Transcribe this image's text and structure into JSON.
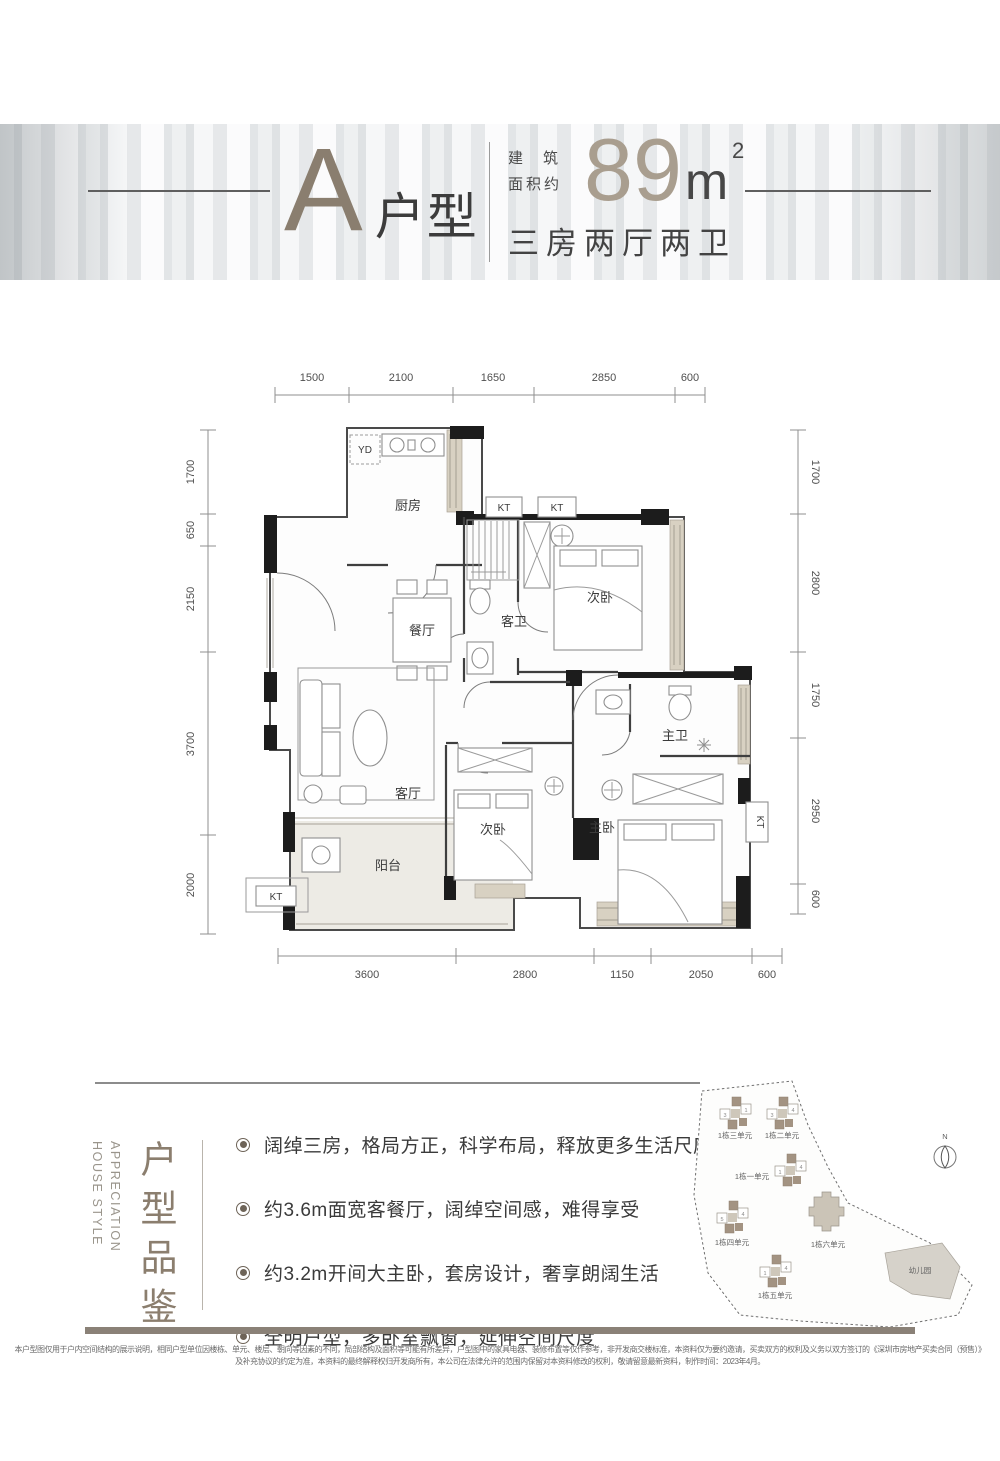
{
  "header": {
    "unit_letter": "A",
    "unit_label": "户型",
    "area_prefix_1": "建筑",
    "area_prefix_2": "面积约",
    "area_number": "89",
    "area_unit": "m",
    "area_sup": "2",
    "layout_desc": "三房两厅两卫"
  },
  "plan": {
    "rooms": {
      "kitchen": "厨房",
      "dining": "餐厅",
      "living": "客厅",
      "guest_bath": "客卫",
      "bedroom_top": "次卧",
      "bedroom_mid": "次卧",
      "master_bed": "主卧",
      "master_bath": "主卫",
      "balcony": "阳台"
    },
    "equipment": {
      "yd": "YD",
      "kt": "KT"
    },
    "dims": {
      "top": [
        "1500",
        "2100",
        "1650",
        "2850",
        "600"
      ],
      "bottom": [
        "3600",
        "2800",
        "1150",
        "2050",
        "600"
      ],
      "left": [
        "1700",
        "650",
        "2150",
        "3700",
        "2000"
      ],
      "right": [
        "1700",
        "2800",
        "1750",
        "2950",
        "600"
      ]
    }
  },
  "features": {
    "title_cn": "户型品鉴",
    "title_en_1": "HOUSE STYLE",
    "title_en_2": "APPRECIATION",
    "bullets": [
      "阔绰三房，格局方正，科学布局，释放更多生活尺度",
      "约3.6m面宽客餐厅，阔绰空间感，难得享受",
      "约3.2m开间大主卧，套房设计，奢享朗阔生活",
      "全明户型，多卧室飘窗，延伸空间尺度"
    ]
  },
  "siteplan": {
    "compass": "N",
    "units": [
      {
        "label": "1栋三单元",
        "digits": [
          "3",
          "1"
        ]
      },
      {
        "label": "1栋二单元",
        "digits": [
          "3",
          "4"
        ]
      },
      {
        "label": "1栋一单元",
        "digits": [
          "1",
          "4"
        ]
      },
      {
        "label": "1栋四单元",
        "digits": [
          "5",
          "4"
        ]
      },
      {
        "label": "1栋五单元",
        "digits": [
          "1",
          "4"
        ]
      },
      {
        "label": "1栋六单元",
        "digits": []
      }
    ],
    "kindergarten": "幼儿园"
  },
  "footer": {
    "disclaimer_line1": "本户型图仅用于户内空间结构的展示说明，相同户型单位因楼栋、单元、楼层、朝向等因素的不同，局部结构及面积等可能有所差异，户型图中的家具电器、装修布置等仅作参考，非开发商交楼标准，本资料仅为要约邀请，买卖双方的权利及义务以双方签订的《深圳市房地产买卖合同（预售）》",
    "disclaimer_line2": "及补充协议的约定为准，本资料的最终解释权归开发商所有，本公司在法律允许的范围内保留对本资料修改的权利，敬请留意最新资料，制作时间：2023年4月。"
  },
  "colors": {
    "accent": "#8b7e6e",
    "wall": "#1c1c1c",
    "window_sill": "#d8d1c2",
    "footer_bar": "#8a8177"
  }
}
